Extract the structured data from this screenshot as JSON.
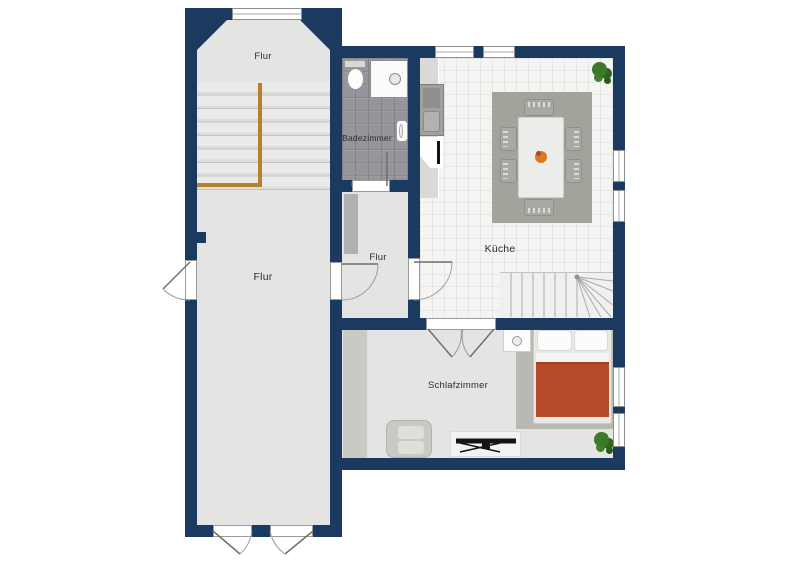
{
  "floor_plan": {
    "type": "residential floor plan",
    "rooms": [
      {
        "name": "flur-upper",
        "label": "Flur"
      },
      {
        "name": "flur-main",
        "label": "Flur"
      },
      {
        "name": "badezimmer",
        "label": "Badezimmer"
      },
      {
        "name": "flur-small",
        "label": "Flur"
      },
      {
        "name": "kueche",
        "label": "Küche"
      },
      {
        "name": "schlafzimmer",
        "label": "Schlafzimmer"
      }
    ],
    "colors": {
      "wall": "#1a3a60",
      "floor": "#e4e4e2",
      "bathroom_tile": "#95959b",
      "kitchen_tile": "#f4f4f2",
      "stair_railing": "#b5812f",
      "bed_duvet": "#b54a2c",
      "kitchen_rug": "#a3a39b",
      "bedroom_rug": "#b9b9b1",
      "plant": "#3c7a2a"
    },
    "features": [
      "staircase-with-railing",
      "winder-staircase",
      "toilet",
      "shower",
      "washbasin",
      "kitchen-counter",
      "stove",
      "sink",
      "dining-table",
      "six-chairs",
      "fruit-bowl",
      "double-bed",
      "pillows",
      "nightstand",
      "wardrobe",
      "cabinet",
      "armchair",
      "tv-sideboard",
      "two-plants",
      "windows",
      "doors"
    ]
  }
}
